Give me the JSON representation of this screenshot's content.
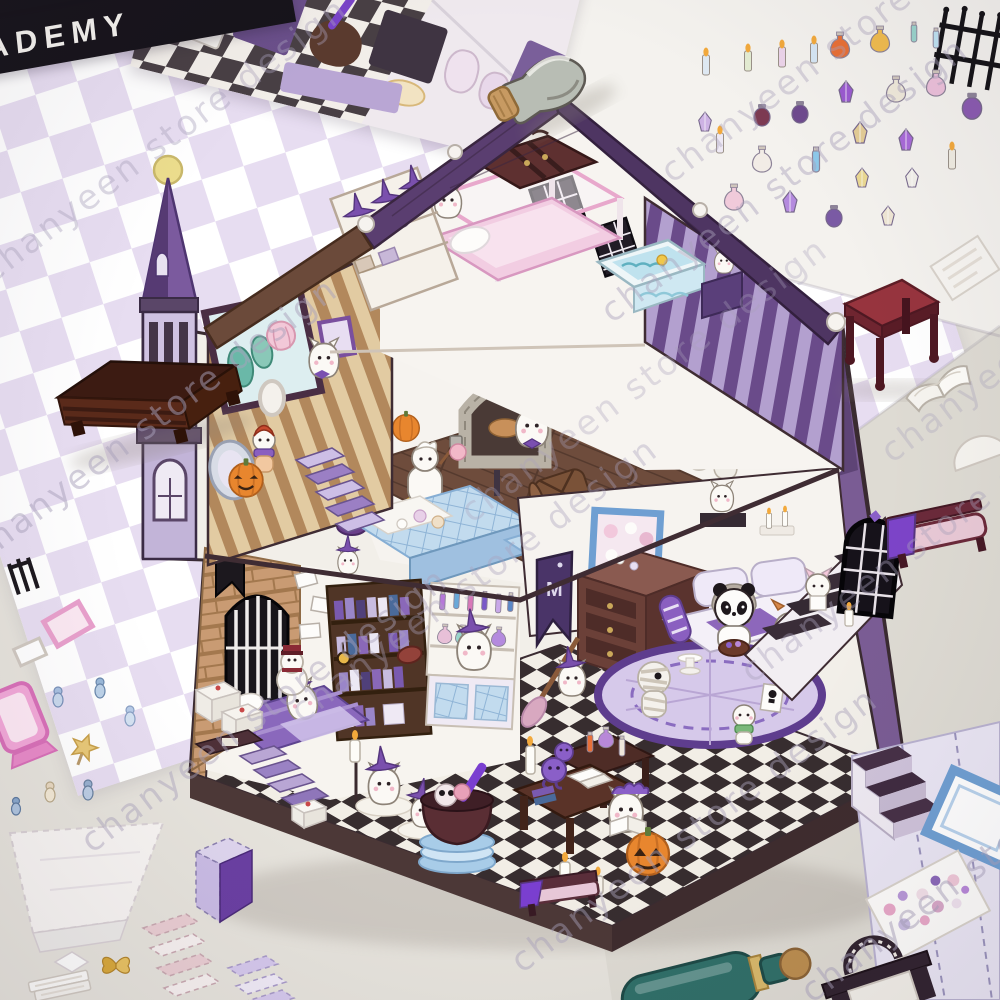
{
  "photo": {
    "watermark_text": "chanyeen store design",
    "academy_banner_text": "ADEMY",
    "wall_flag_letter": "M"
  },
  "palette": {
    "surface": "#e6e3dc",
    "checker_white": "#ffffff",
    "checker_lilac": "#e7ddf1",
    "roof_purple": "#5a3e70",
    "turret_purple": "#7b5a9e",
    "brick_tan": "#c99b73",
    "floor_checker_dark": "#372d2f",
    "counter_blue": "#c2dbee",
    "table_maroon": "#97343e",
    "bottle_teal": "#2f6f68",
    "banner_black": "#16131a",
    "sticker_sheet_white": "#f4f2ee"
  },
  "objects": {
    "house_rooms": [
      "turret",
      "roof",
      "attic-bedroom",
      "dressing-room",
      "bakery-kitchen",
      "library-bedroom",
      "living-room",
      "checkered-floor"
    ],
    "stickers": [
      "academy-scene-sheet",
      "checkerboard-paper",
      "glass-cork-bottle",
      "potion-sticker-field",
      "iron-fence",
      "maroon-table",
      "white-card",
      "open-book",
      "white-round-paper",
      "purple-bench",
      "brown-cabinet",
      "pale-panel",
      "stair-sticker",
      "blue-frame",
      "mini-character-sheet",
      "fireplace-sticker",
      "teal-bottle",
      "pink-mirror",
      "pink-frame",
      "white-frame",
      "gate-piece",
      "mini-figures",
      "lollipop",
      "white-box-template",
      "purple-box",
      "striped-stair-piece",
      "lavender-piece",
      "white-books",
      "gold-butterfly"
    ]
  }
}
